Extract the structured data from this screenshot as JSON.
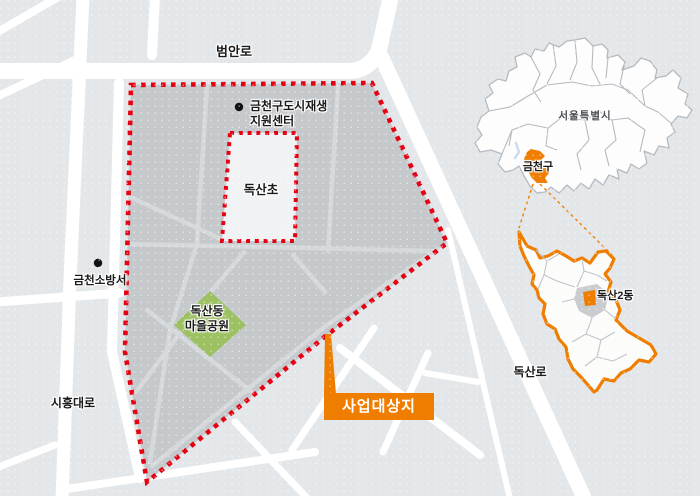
{
  "figure": {
    "type": "location-map",
    "road_labels": {
      "top_road": "범안로",
      "left_road": "시흥대로",
      "right_road": "독산로"
    },
    "pois": {
      "regen_center": {
        "line1": "금천구도시재생",
        "line2": "지원센터"
      },
      "school": "독산초",
      "fire_station": "금천소방서",
      "park": {
        "line1": "독산동",
        "line2": "마을공원"
      }
    },
    "callout": {
      "label": "사업대상지"
    },
    "inset": {
      "city_label": "서울특별시",
      "district_label": "금천구",
      "dong_label": "독산2동"
    },
    "colors": {
      "boundary_red": "#e60012",
      "accent_orange": "#ef7d00",
      "park_green": "#9dc162",
      "project_area_gray": "#c5c9cc"
    }
  }
}
